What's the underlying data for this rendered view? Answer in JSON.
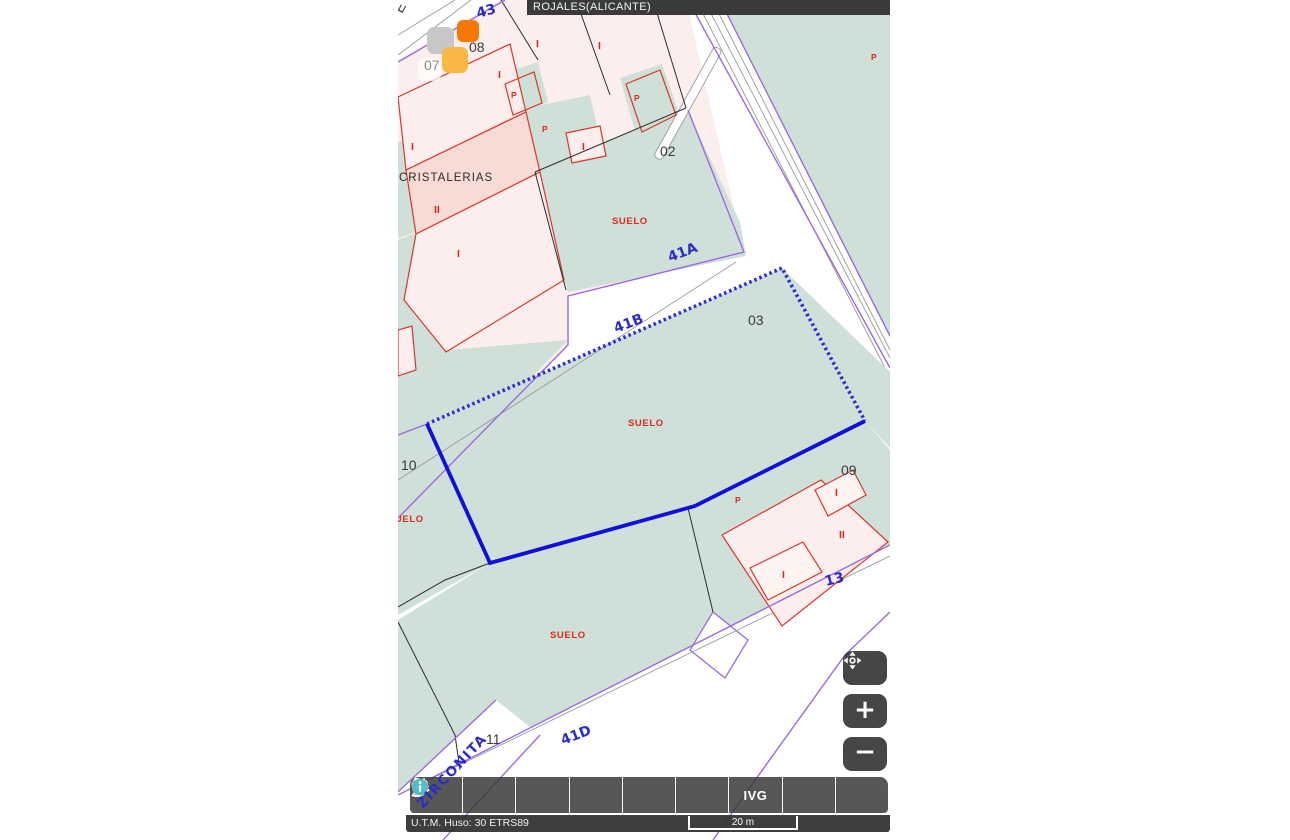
{
  "header": {
    "title": "ROJALES(ALICANTE)"
  },
  "map": {
    "labels": {
      "street_e": "E",
      "street_43": "43",
      "street_41a": "41A",
      "street_41b": "41B",
      "street_41d": "41D",
      "street_13": "13",
      "street_zirconita": "ZIRCONITA",
      "parcel_02": "02",
      "parcel_03": "03",
      "parcel_07": "07",
      "parcel_08": "08",
      "parcel_09": "09",
      "parcel_10": "10",
      "parcel_11": "11",
      "cristalerias": "CRISTALERIAS",
      "suelo": "SUELO",
      "floor_i": "I",
      "floor_ii": "II",
      "mark_p": "P"
    },
    "colors": {
      "parcel_green": "#cfe0d8",
      "building_pink": "#fceeec",
      "building_pink_dark": "#f8dbd4",
      "building_outline_red": "#d8362a",
      "boundary_purple": "#9a6be0",
      "selection_blue": "#1010d8",
      "street_text_blue": "#2a2cc6",
      "label_red": "#e0291b",
      "marker_orange": "#f57900",
      "marker_amber": "#f9b844",
      "marker_gray": "#c7c7c7",
      "toolbar_dark": "#3a3a3a",
      "info_teal": "#56bec3"
    }
  },
  "toolbar": {
    "buttons": [
      {
        "name": "expand-panel"
      },
      {
        "name": "search"
      },
      {
        "name": "layers"
      },
      {
        "name": "measure"
      },
      {
        "name": "print"
      },
      {
        "name": "pointer-info",
        "label": "P"
      },
      {
        "name": "ivg",
        "label": "IVG"
      },
      {
        "name": "cartography-3d"
      },
      {
        "name": "information"
      }
    ]
  },
  "map_controls": {
    "zoom_in": "+",
    "zoom_out": "−"
  },
  "statusbar": {
    "utm": "U.T.M. Huso: 30 ETRS89",
    "scale": "20 m"
  }
}
